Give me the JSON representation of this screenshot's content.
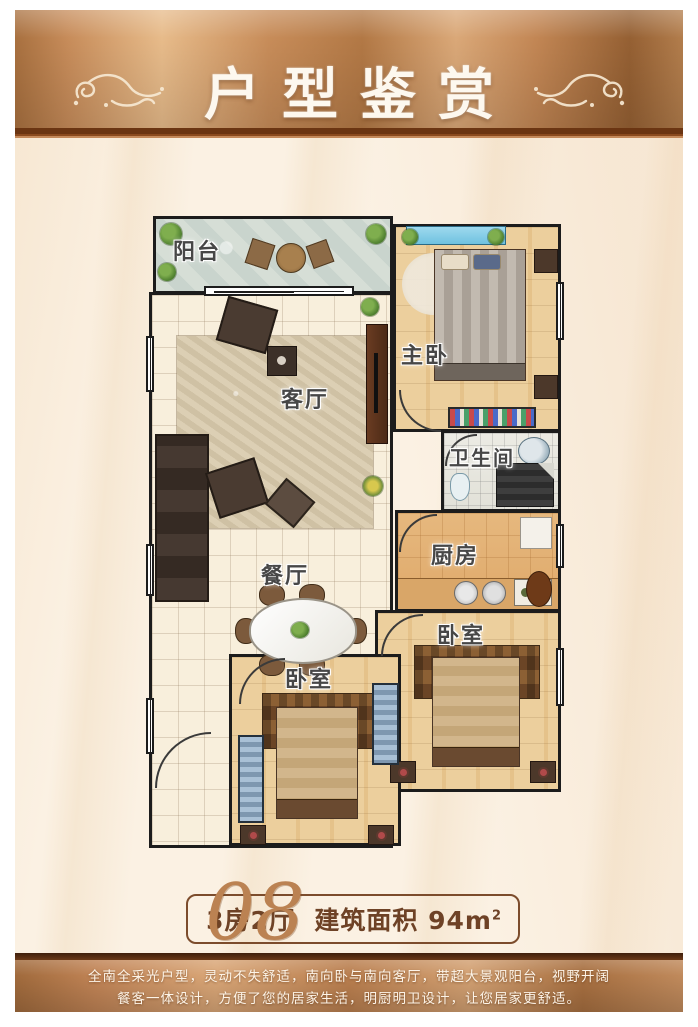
{
  "banner": {
    "title": "户型鉴赏"
  },
  "rooms": {
    "balcony": {
      "label": "阳台"
    },
    "master": {
      "label": "主卧"
    },
    "living": {
      "label": "客厅"
    },
    "bathroom": {
      "label": "卫生间"
    },
    "kitchen": {
      "label": "厨房"
    },
    "dining": {
      "label": "餐厅"
    },
    "bedroom_right": {
      "label": "卧室"
    },
    "bedroom_left": {
      "label": "卧室"
    }
  },
  "badge": {
    "number": "08",
    "layout": "3房2厅",
    "area_label": "建筑面积",
    "area_value": "94m",
    "area_sup": "2"
  },
  "footer": {
    "line1": "全南全采光户型，灵动不失舒适，南向卧与南向客厅，带超大景观阳台，视野开阔",
    "line2": "餐客一体设计，方便了您的居家生活，明厨明卫设计，让您居家更舒适。"
  },
  "colors": {
    "banner_copper": "#c28a5a",
    "banner_rule": "#6b3512",
    "badge_text": "#6e4226",
    "wall": "#1c1c1c",
    "backdrop_cream": "#fbf1e4"
  }
}
